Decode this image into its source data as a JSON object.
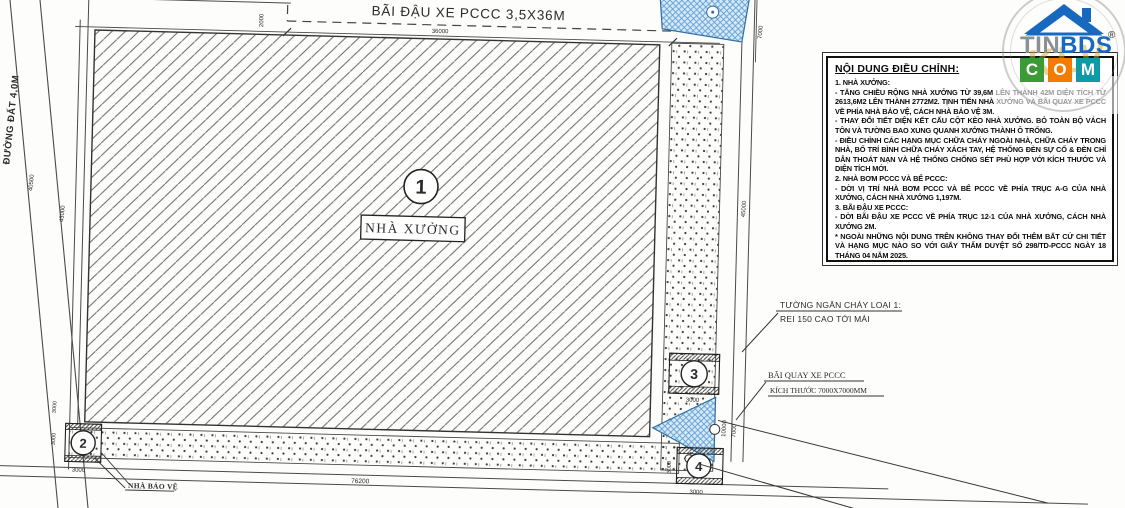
{
  "plan": {
    "road_label": "ĐƯỜNG ĐẤT 4,0M",
    "parking_label": "BÃI ĐẬU XE PCCC 3,5X36M",
    "factory_label": "NHÀ XƯỞNG",
    "guard_house_label": "NHÀ BẢO VỆ",
    "markers": {
      "factory": "1",
      "guard": "2",
      "pump": "3",
      "tank": "4"
    },
    "callouts": {
      "firewall_line1": "TƯỜNG NGĂN CHÁY LOẠI 1:",
      "firewall_line2": "REI 150 CAO TỚI MÁI",
      "turnaround_line1": "BÃI QUAY XE PCCC",
      "turnaround_line2": "KÍCH THƯỚC 7000X7000MM"
    },
    "dimensions": {
      "parking_length": "36000",
      "parking_gap": "2000",
      "site_width": "76200",
      "left_a": "40500",
      "left_b": "43000",
      "right_a": "45000",
      "tank_width": "7000",
      "right_b": "10000",
      "right_c": "7000",
      "small": "3000"
    }
  },
  "notes": {
    "title": "NỘI DUNG ĐIỀU CHỈNH:",
    "lines": [
      "1. NHÀ XƯỞNG:",
      "- TĂNG CHIỀU RỘNG NHÀ XƯỞNG TỪ 39,6M LÊN THÀNH 42M DIỆN TÍCH TỪ 2613,6M2 LÊN THÀNH 2772M2. TỊNH TIẾN NHÀ XƯỞNG VÀ BÃI QUAY XE PCCC VỀ PHÍA NHÀ BẢO VỆ, CÁCH NHÀ BẢO VỆ 3M.",
      "- THAY ĐỔI TIẾT DIỆN KẾT CẤU CỘT KÈO NHÀ XƯỞNG. BỎ TOÀN BỘ VÁCH TÔN VÀ TƯỜNG BAO XUNG QUANH XƯỞNG THÀNH Ô TRỐNG.",
      "- ĐIỀU CHỈNH CÁC HẠNG MỤC CHỮA CHÁY NGOÀI NHÀ, CHỮA CHÁY TRONG NHÀ, BỐ TRÍ BÌNH CHỮA CHÁY XÁCH TAY, HỆ THỐNG ĐÈN SỰ CỐ & ĐÈN CHỈ DẪN THOÁT NẠN VÀ HỆ THỐNG CHỐNG SÉT PHÙ HỢP VỚI KÍCH THƯỚC VÀ DIỆN TÍCH MỚI.",
      "2. NHÀ BƠM PCCC VÀ BỂ PCCC:",
      "- DỜI VỊ TRÍ NHÀ BƠM PCCC VÀ BỂ PCCC VỀ PHÍA TRỤC A-G CỦA NHÀ XƯỞNG, CÁCH NHÀ XƯỞNG 1,197M.",
      "3. BÃI ĐẬU XE PCCC:",
      "- DỜI BÃI ĐẬU XE PCCC VỀ PHÍA TRỤC 12-1 CỦA NHÀ XƯỞNG, CÁCH NHÀ XƯỞNG 2M.",
      "* NGOÀI NHỮNG NỘI DUNG TRÊN KHÔNG THAY ĐỔI THÊM BẤT CỨ CHI TIẾT VÀ HẠNG MỤC NÀO SO VỚI GIẤY THẨM DUYỆT SỐ 298/TD-PCCC NGÀY 18 THÁNG 04 NĂM 2025."
    ]
  },
  "logo": {
    "tin": "TIN",
    "bds": "BDS",
    "c": "C",
    "o": "O",
    "m": "M",
    "reg": "®",
    "watermark": "KLV"
  },
  "colors": {
    "blue_fill": "#d6e9f5",
    "blue_line": "#5b9bd5",
    "logo_blue": "#1769c0",
    "logo_green": "#3d9b35",
    "logo_orange": "#f07d00",
    "logo_teal": "#0e9aa7",
    "line": "#3a3a3a"
  }
}
